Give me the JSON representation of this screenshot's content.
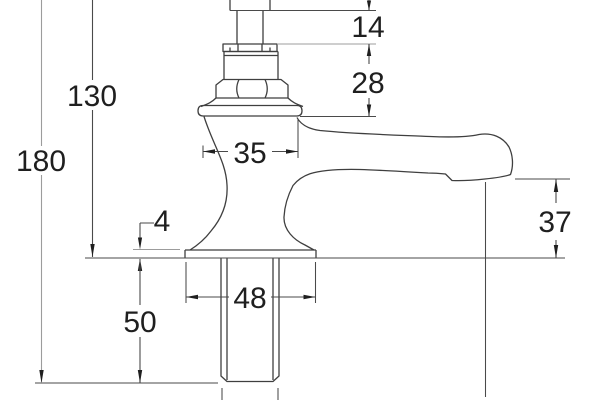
{
  "drawing": {
    "kind": "technical-dimension-drawing",
    "subject": "basin pillar tap side elevation with dimension annotations",
    "line_color": "#3f3f3f",
    "dim_line_color": "#4a4a4a",
    "light_line_color": "#9c9c9c",
    "text_color": "#1f1f1f",
    "background": "#ffffff",
    "dims": {
      "overall_height": "180",
      "height_above_deck": "130",
      "spindle_exposed": "14",
      "bonnet_height": "28",
      "body_width": "35",
      "base_thickness": "4",
      "spout_clearance": "37",
      "base_width": "48",
      "tail_length": "50"
    }
  }
}
